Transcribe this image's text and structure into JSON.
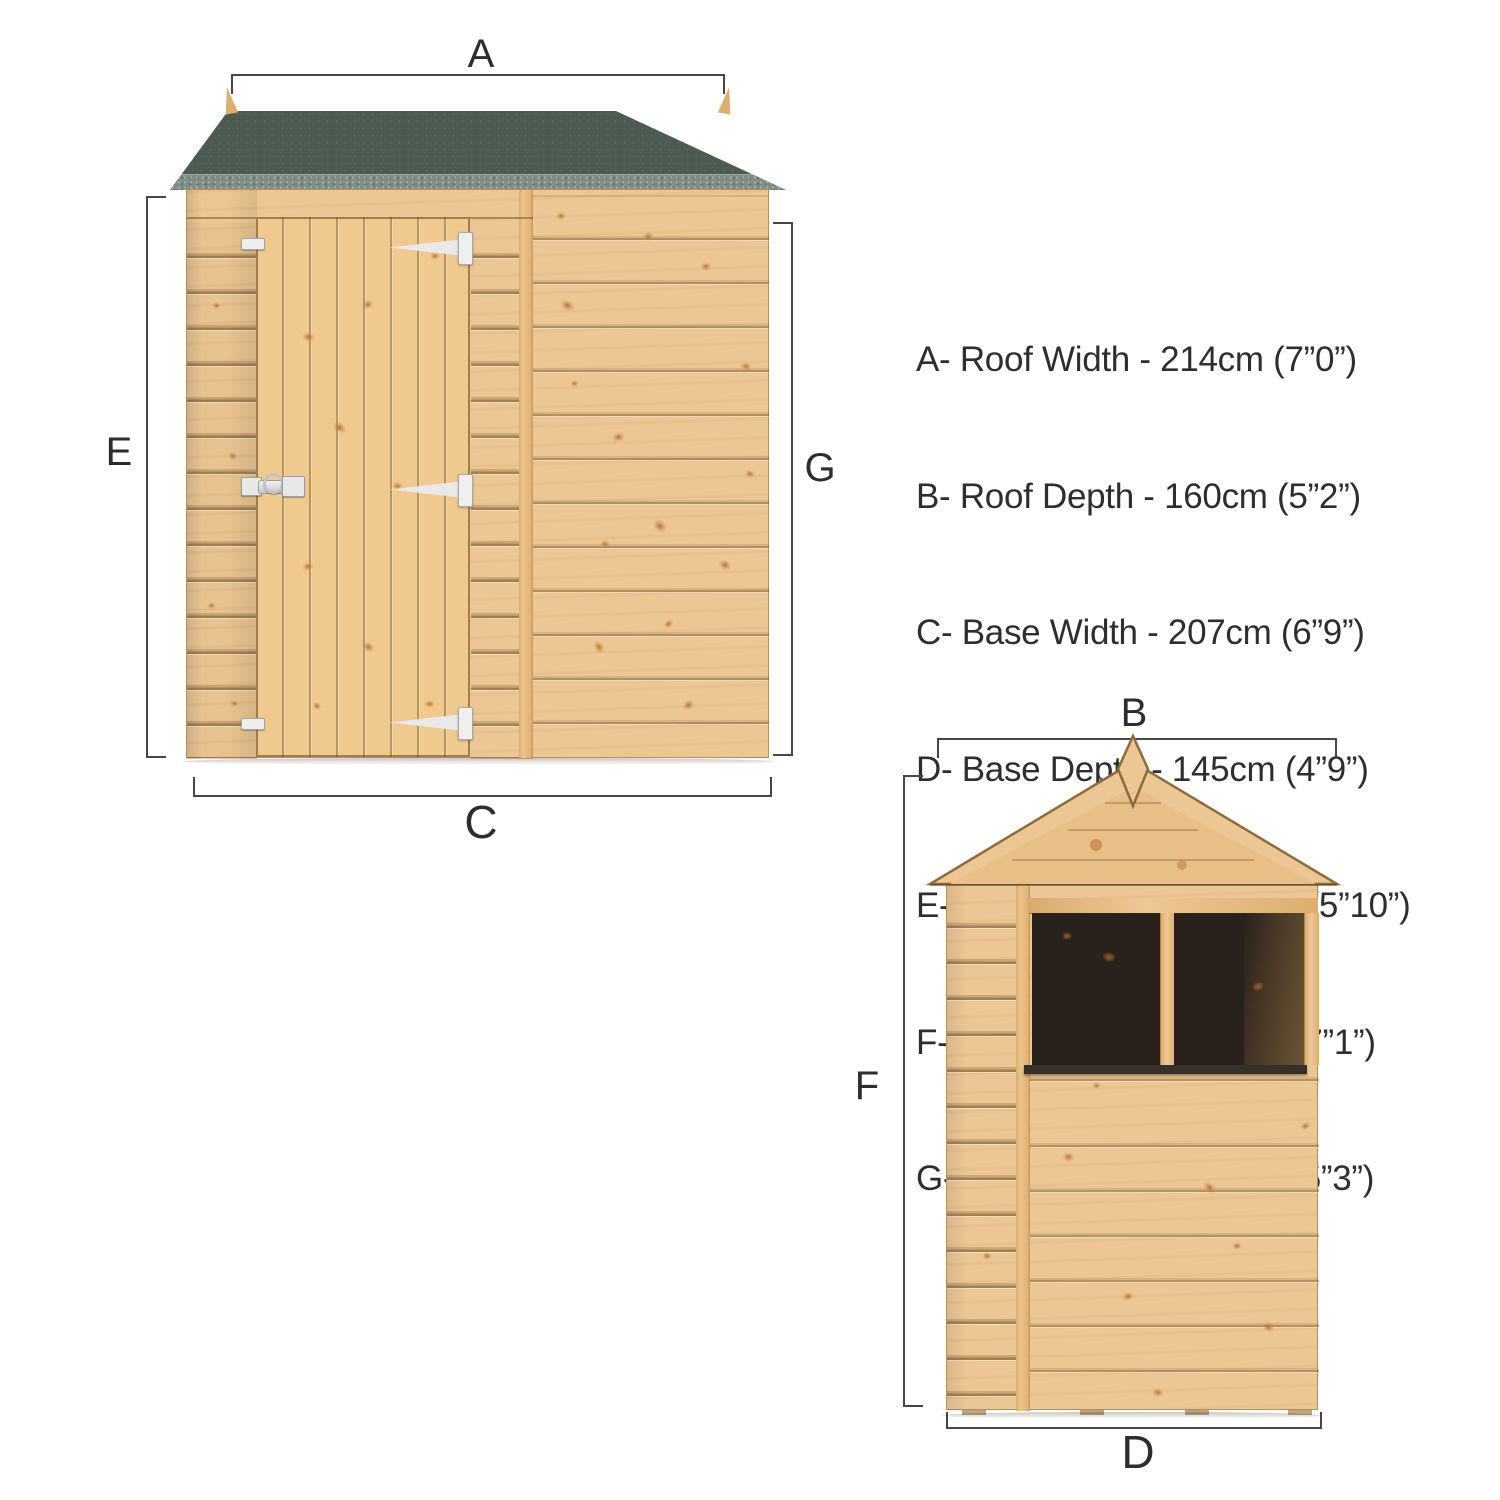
{
  "diagram": {
    "type": "shed-dimension-diagram",
    "views": {
      "front": {
        "labels": {
          "roof_width": "A",
          "base_width": "C",
          "eaves_height": "E",
          "door_height": "G"
        }
      },
      "side": {
        "labels": {
          "roof_depth": "B",
          "base_depth": "D",
          "roof_height": "F"
        }
      }
    },
    "legend": {
      "items": [
        "A- Roof Width - 214cm (7”0”)",
        "B- Roof Depth - 160cm (5”2”)",
        "C- Base Width - 207cm (6”9”)",
        "D- Base Depth - 145cm (4”9”)",
        "E- Eaves Height - 180cm (5”10”)",
        "F- Roof Height -  216cm (7”1”)",
        "G- Door Height - 161cm (5”3”)"
      ]
    },
    "colors": {
      "roof_felt": "#4d5a52",
      "roof_felt_edge": "#7f8d86",
      "wood_light": "#ecc793",
      "wood_mid": "#e2b67c",
      "window_dark": "#29211b",
      "dimension_line": "#464646",
      "text": "#2e2e2e",
      "background": "#ffffff"
    }
  }
}
